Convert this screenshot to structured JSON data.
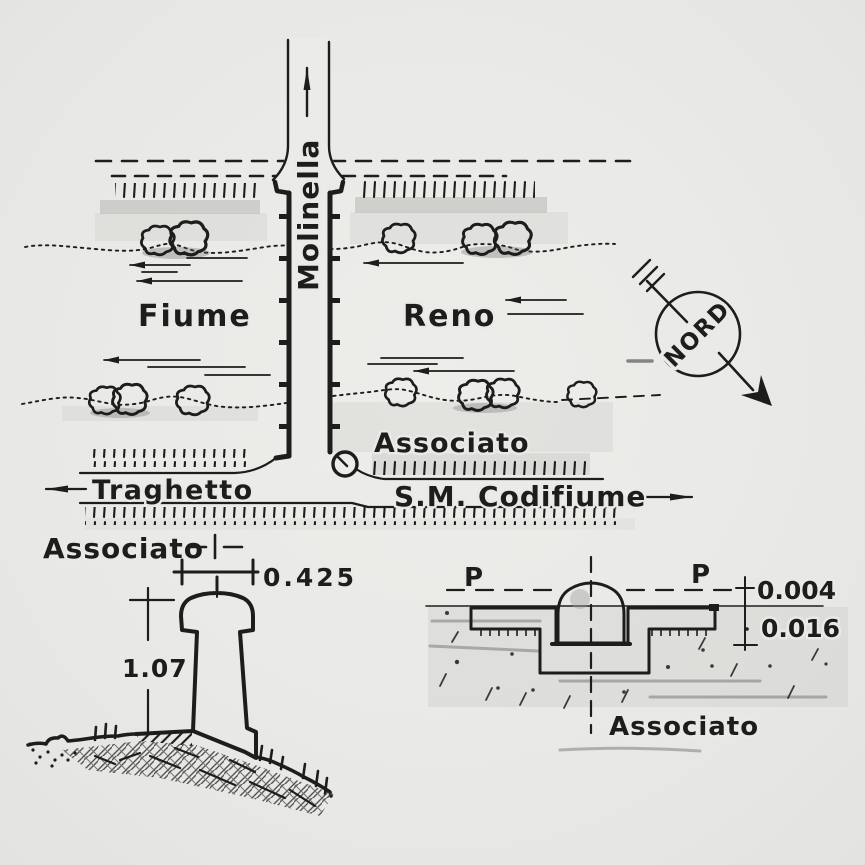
{
  "map": {
    "channel_label": "Molinella",
    "river_left_label": "Fiume",
    "river_right_label": "Reno",
    "marker_label": "Associato",
    "road_left_label": "Traghetto",
    "road_right_label": "S.M. Codifiume",
    "compass_label": "NORD"
  },
  "legend": {
    "marker_label": "Associato"
  },
  "detail_monument": {
    "width_dim": "0.425",
    "height_dim": "1.07"
  },
  "detail_plate": {
    "label": "Associato",
    "pavement_left": "P",
    "pavement_right": "P",
    "dim_above": "0.004",
    "dim_below": "0.016"
  },
  "colors": {
    "ink": "#1d1d1b",
    "paper": "#e9e9e7"
  }
}
